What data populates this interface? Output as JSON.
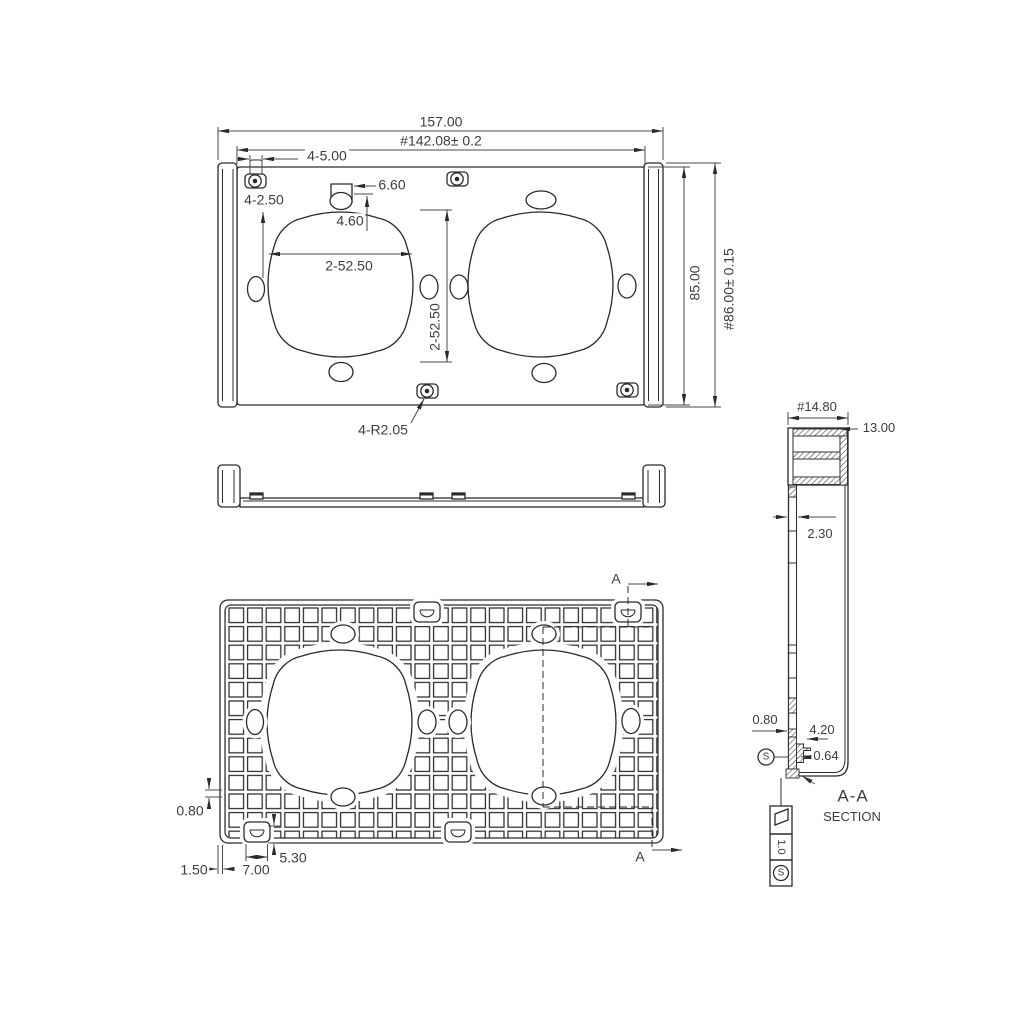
{
  "drawing": {
    "section_title": "A-A",
    "section_subtitle": "SECTION"
  },
  "top_view": {
    "overall_width": "157.00",
    "mount_width": "#142.08± 0.2",
    "boss_width": "4-5.00",
    "hole_diameter": "4-2.50",
    "notch_width": "6.60",
    "notch_depth": "4.60",
    "opening_width": "2-52.50",
    "opening_height": "2-52.50",
    "plate_height": "85.00",
    "overall_height": "#86.00± 0.15",
    "corner_radius": "4-R2.05"
  },
  "section_view": {
    "rail_width": "#14.80",
    "rail_depth": "13.00",
    "wall_thickness": "2.30",
    "rib_thickness": "0.80",
    "foot_height": "4.20",
    "foot_lip": "0.64",
    "datum_modifier": "S",
    "flatness_tolerance": "1.0",
    "flatness_modifier": "S"
  },
  "bottom_view": {
    "rib_offset": "0.80",
    "wall_thickness": "1.50",
    "boss_width": "7.00",
    "boss_height": "5.30",
    "section_marker_top": "A",
    "section_marker_bottom": "A"
  }
}
